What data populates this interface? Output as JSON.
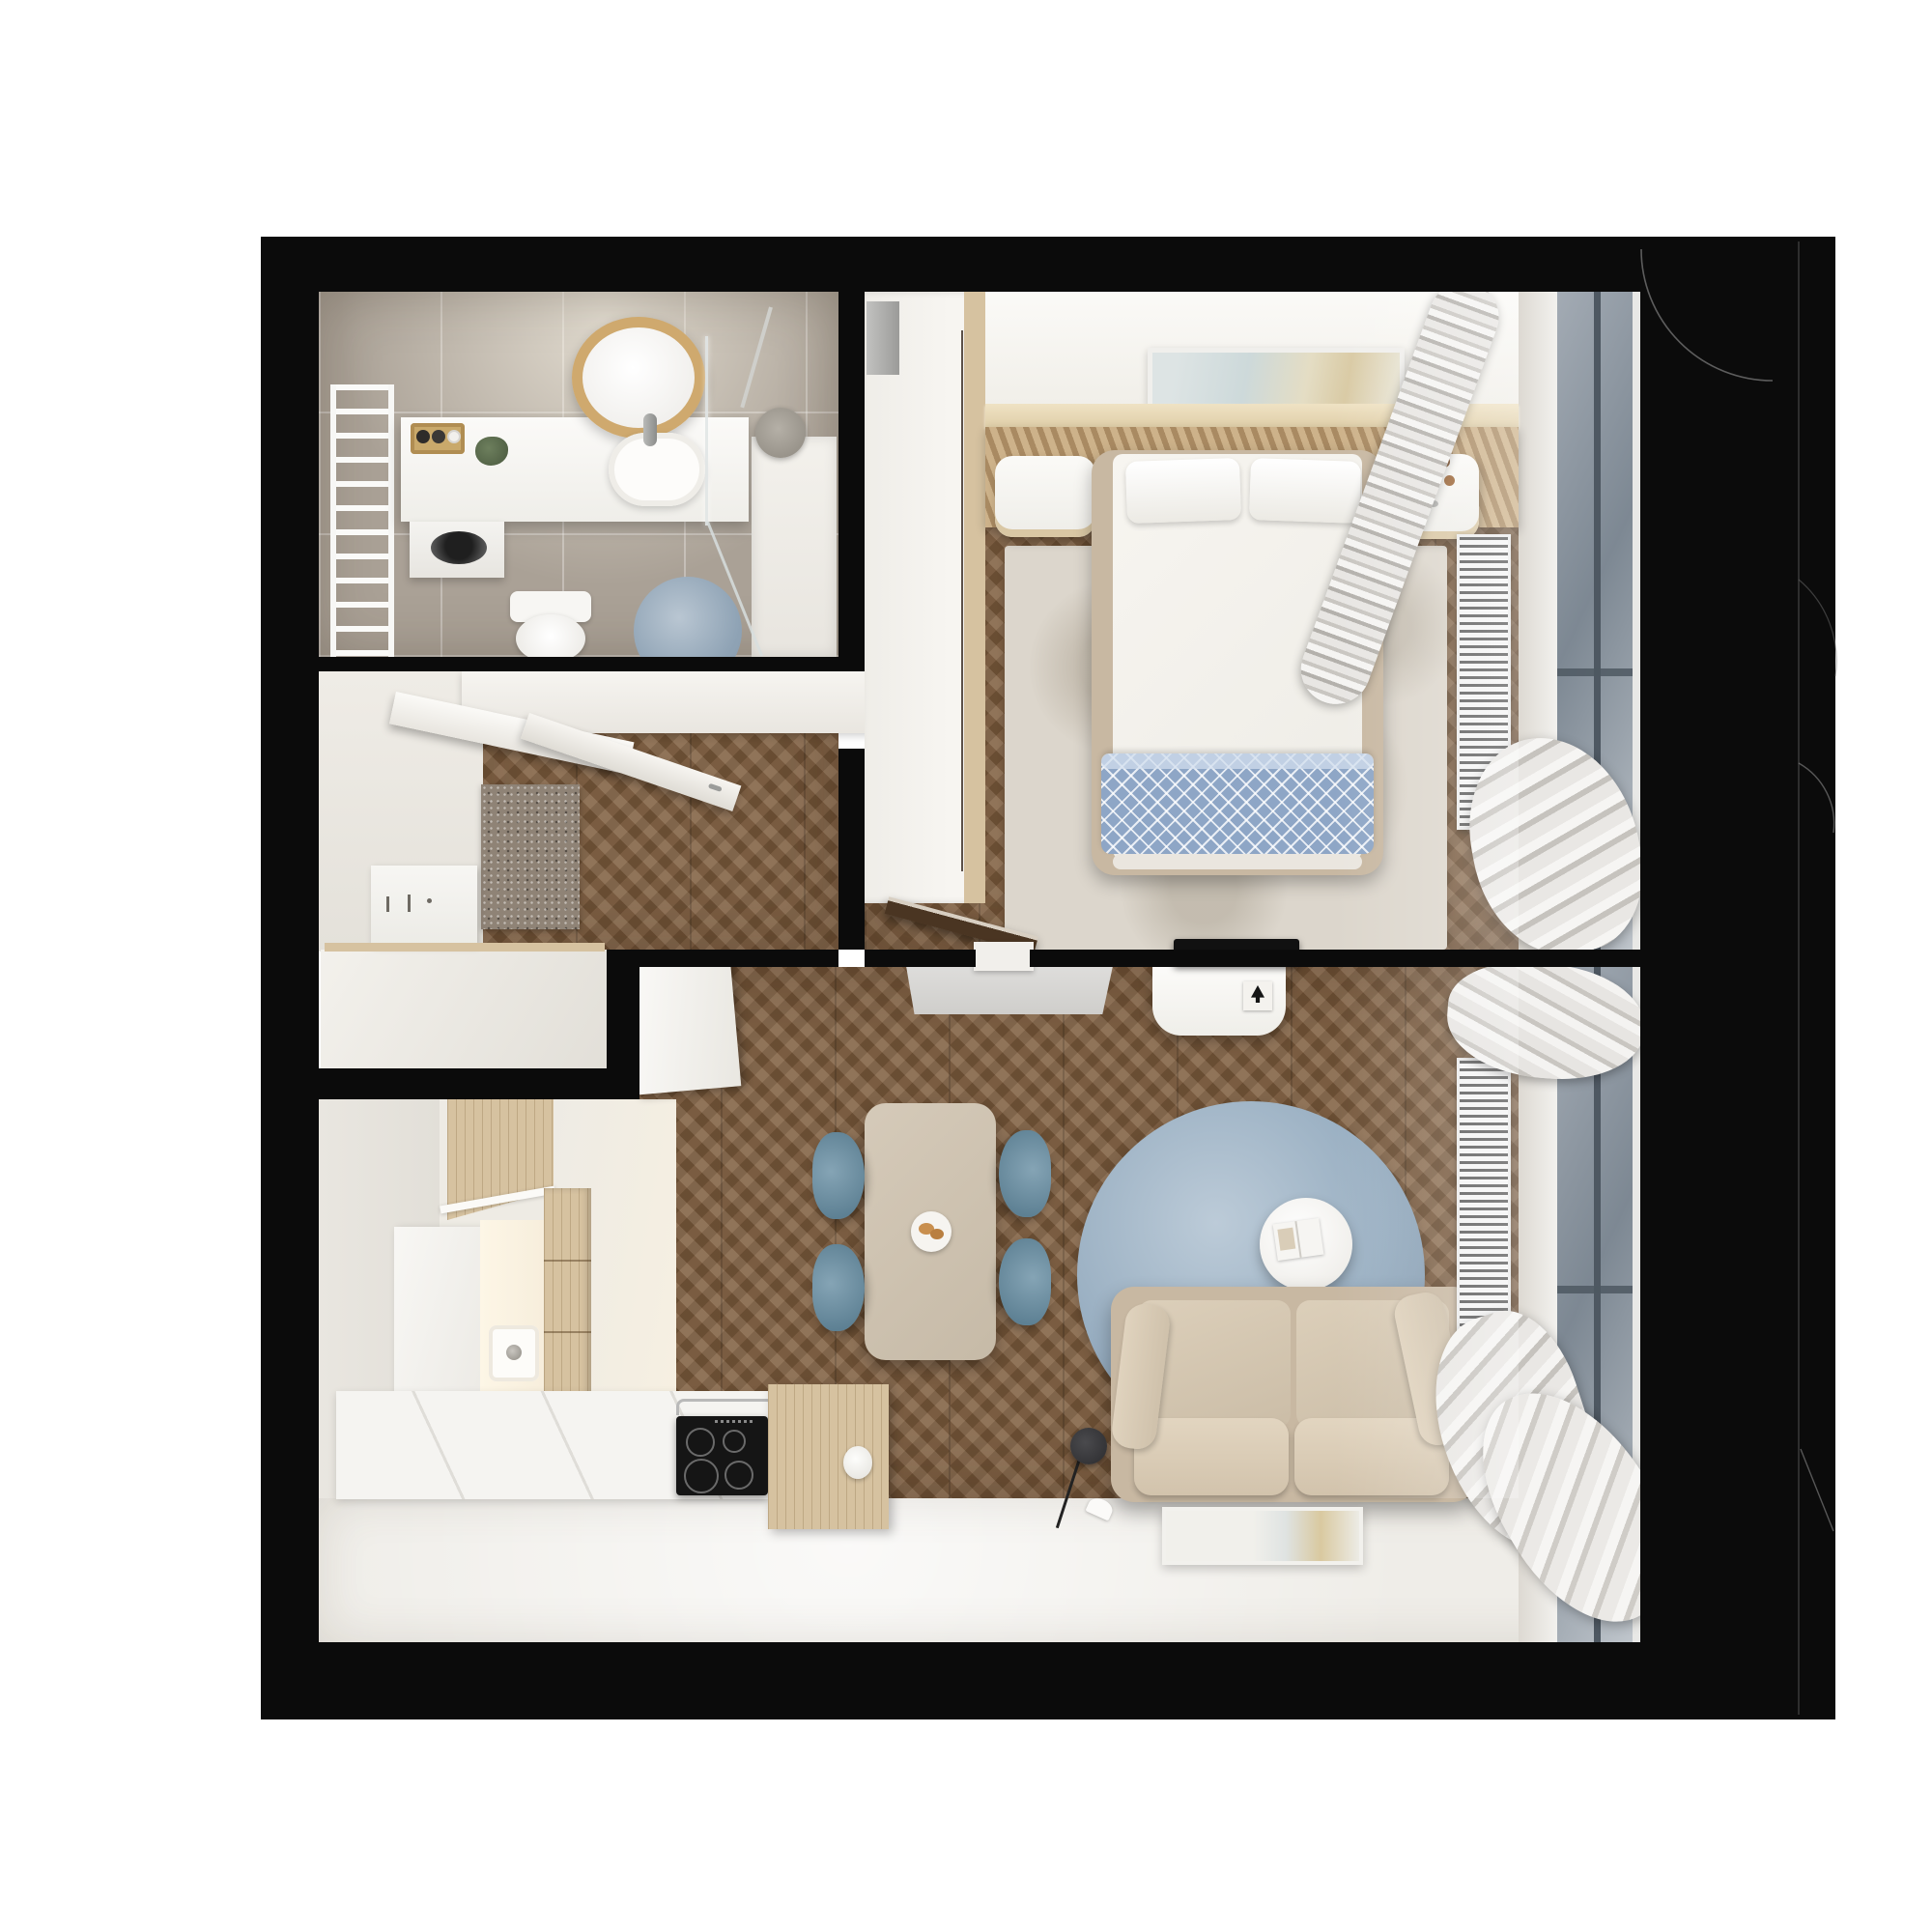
{
  "title": "apartment-floor-plan-3d-render",
  "colors": {
    "wall": "#0b0b0b",
    "wood": "#7d5c3c",
    "tile": "#aaa196",
    "whiteFloor": "#efede8",
    "counter": "#f6f5f2",
    "oak": "#d6c2a0",
    "rugBeige": "#dcd6cc",
    "rugBlue": "#93a9bd",
    "matGray": "#8f8376",
    "sofa": "#c8b8a2",
    "sofaCushion": "#d7c9b3",
    "tableBeige": "#cdc1af",
    "chairBlue": "#7495a8",
    "throwBlue": "#8ea6c6",
    "slat": "#cdb28a",
    "slatDark": "#a98a62",
    "shelfWood": "#e6d7b8",
    "curtainLight": "#f3f2f0",
    "curtainMid": "#c9c6c1",
    "glass": "#98a1ab",
    "mullion": "#4e5862",
    "radStripe": "#5c5c5c",
    "radBg": "#f4f4f4",
    "doorDark": "#4a3522",
    "white": "#f8f7f5",
    "grayShelf": "#d6d5d2",
    "lamp": "#353538"
  },
  "rooms": [
    {
      "id": "bathroom",
      "floor": "gray-tile"
    },
    {
      "id": "hallway",
      "floor": "chevron-wood"
    },
    {
      "id": "closet",
      "floor": "white"
    },
    {
      "id": "bedroom",
      "floor": "chevron-wood"
    },
    {
      "id": "living-dining",
      "floor": "chevron-wood"
    },
    {
      "id": "kitchen",
      "floor": "white"
    }
  ],
  "furniture": [
    "towel-radiator",
    "vanity-counter",
    "round-mirror",
    "basin-sink",
    "washing-machine",
    "toilet",
    "bath-rug",
    "shower-tray",
    "shower-head",
    "glass-screen",
    "entry-door",
    "bathroom-door",
    "doormat",
    "entry-console",
    "wardrobe",
    "headboard-slats",
    "wall-art",
    "nightstand-left",
    "nightstand-right",
    "double-bed",
    "pillows",
    "blue-throw",
    "bedroom-rug",
    "bedroom-radiator",
    "bedroom-window",
    "curtains",
    "bedroom-door",
    "tv-console",
    "tv",
    "wall-shelf",
    "dining-table",
    "dining-chairs",
    "centerpiece-plate",
    "round-blue-rug",
    "coffee-table",
    "sofa",
    "floor-lamp",
    "leaning-picture",
    "kitchen-upper-cabinets",
    "kitchen-counter",
    "kitchen-sink",
    "cooktop",
    "kitchen-wood-cabinet",
    "living-radiator",
    "living-window"
  ]
}
